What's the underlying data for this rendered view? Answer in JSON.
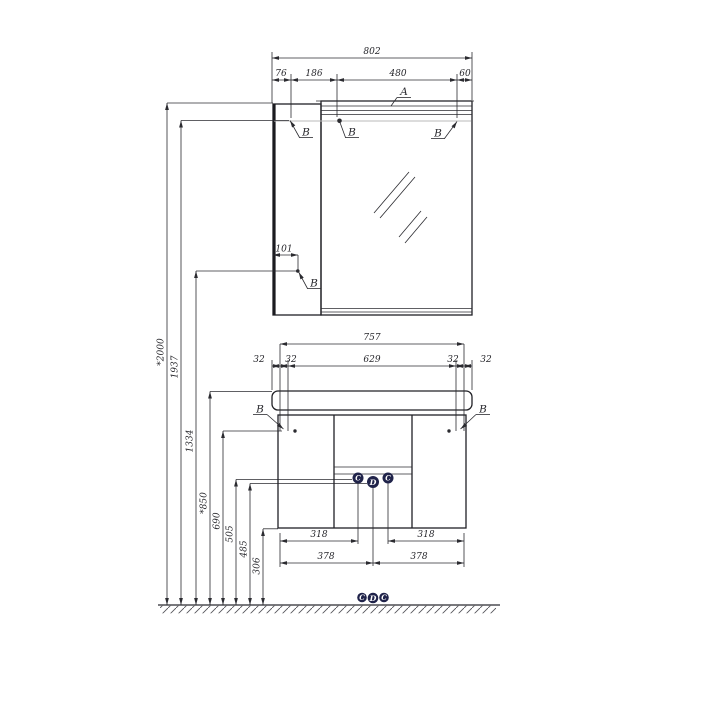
{
  "drawing": {
    "callouts": {
      "a": "A",
      "b": "B",
      "c": "C",
      "d": "D"
    },
    "mirror_unit": {
      "total_width": "802",
      "segments": [
        "76",
        "186",
        "480",
        "60"
      ],
      "side_offset": "101"
    },
    "vanity_unit": {
      "total_width": "757",
      "top_segments": [
        "32",
        "32",
        "629",
        "32",
        "32"
      ],
      "bottom_inner": [
        "318",
        "318"
      ],
      "bottom_outer": [
        "378",
        "378"
      ]
    },
    "heights": [
      "*2000",
      "1937",
      "1334",
      "*850",
      "690",
      "505",
      "485",
      "306"
    ]
  }
}
